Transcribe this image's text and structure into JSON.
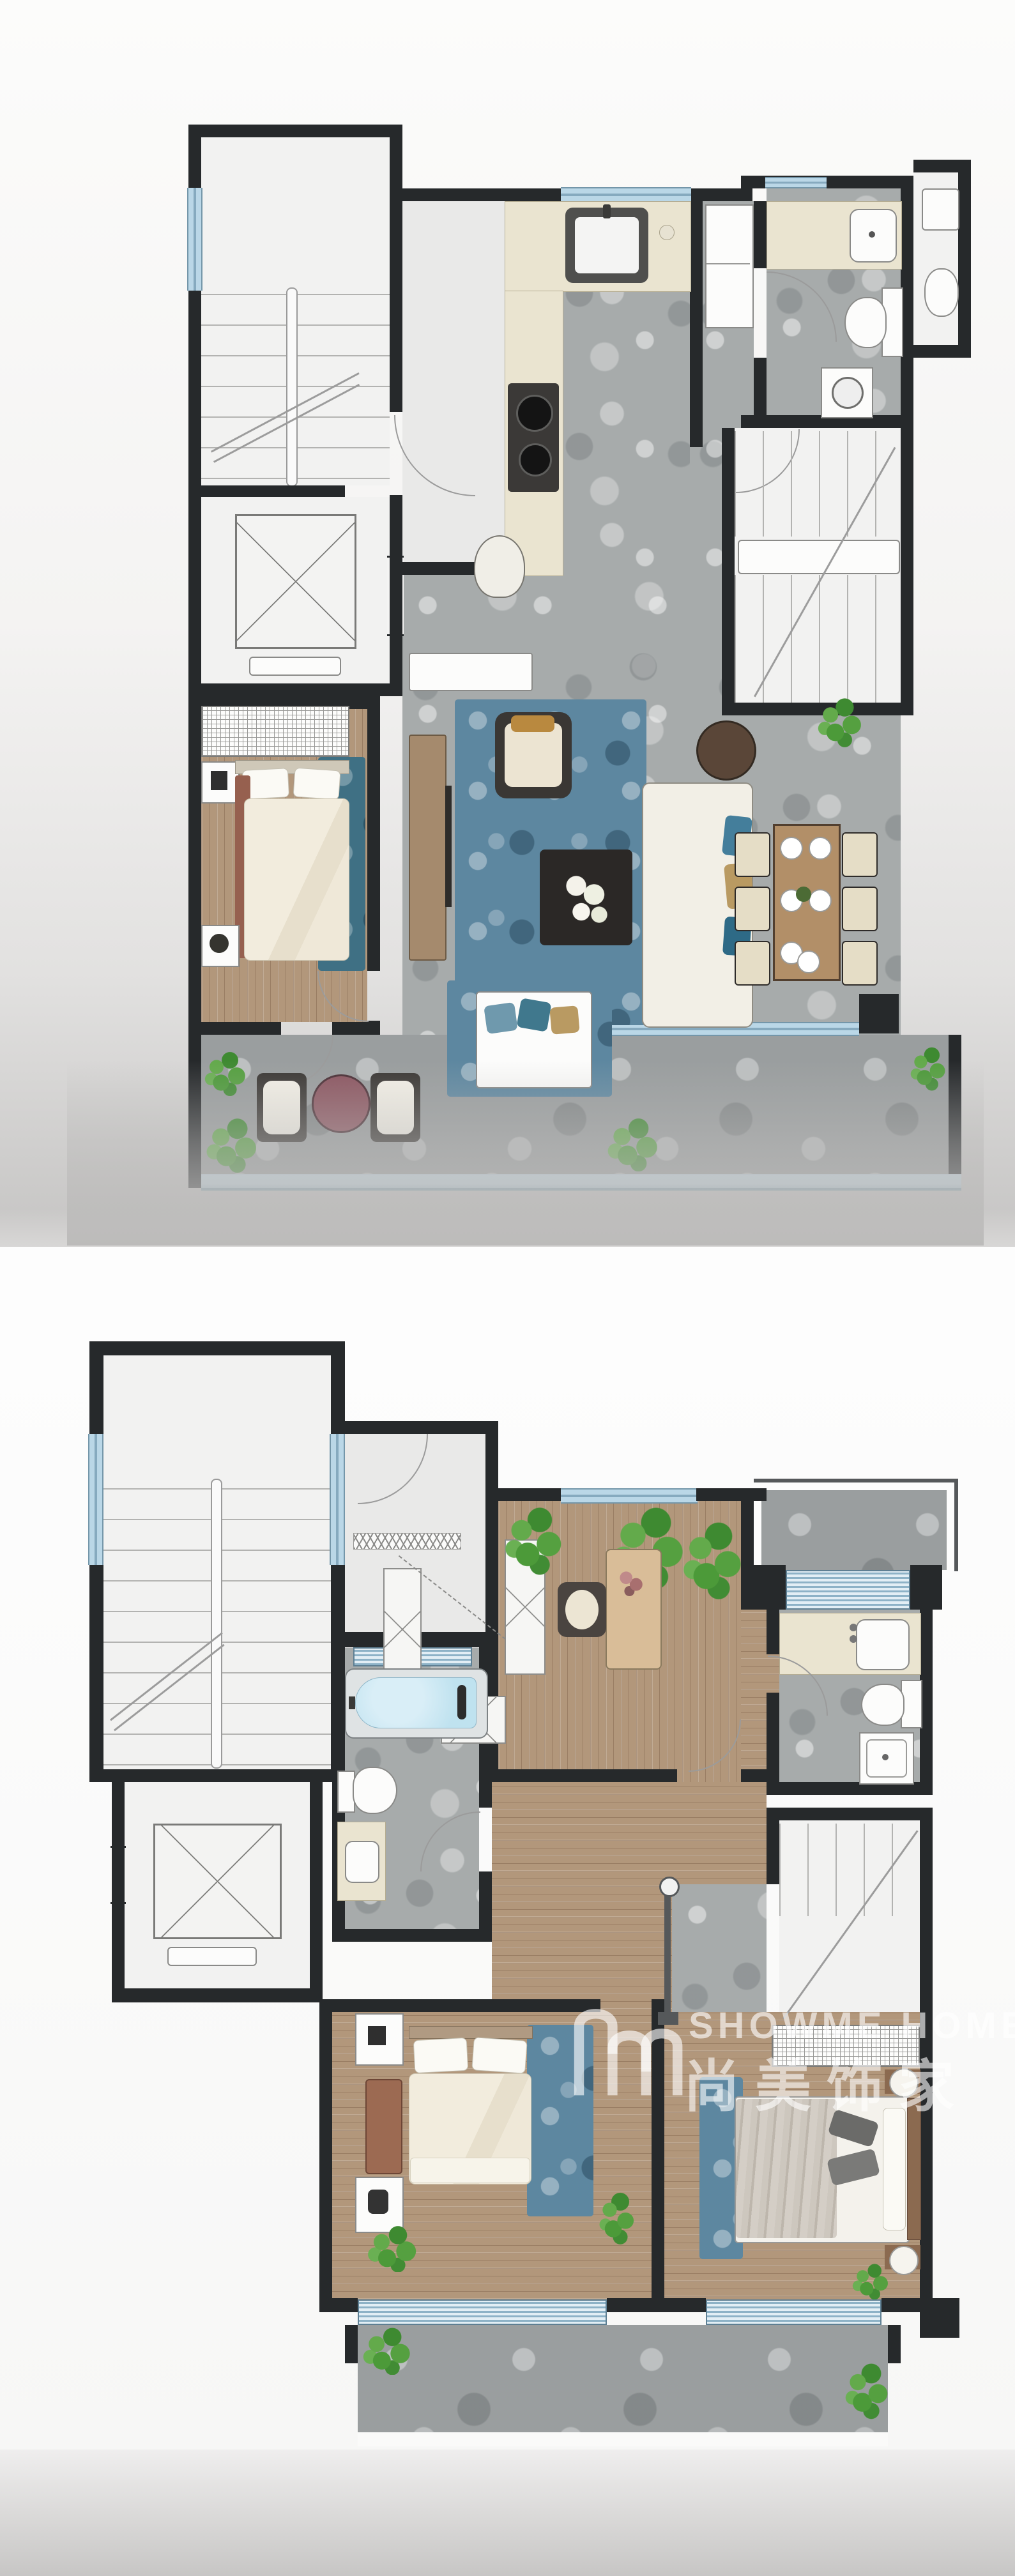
{
  "watermark": {
    "brand_latin": "SHOWME HOME",
    "brand_cn": "尚美饰家",
    "logo": "showme-home-bridge-m-logo",
    "text_color": "#ffffff",
    "opacity": 0.6
  },
  "palette": {
    "wall": "#26292b",
    "stone_floor": "#a7abab",
    "outdoor_stone": "#9a9e9f",
    "wood_floor": "#b2977b",
    "white_floor": "#f2f2f1",
    "window_glass": "#bad7e7",
    "louver_glass": "#8db2c7",
    "rug_blue": "#5d87a0",
    "rug_teal": "#3f7084",
    "counter_beige": "#eae4d0",
    "bathtub_water": "#bfe2ef",
    "plant_green": "#55a040",
    "outdoor_table_maroon": "#8c5661",
    "page_background": "#f6f6f5"
  },
  "plans": [
    {
      "id": "floor-plan-upper-image",
      "position": "top",
      "rooms": [
        "shared-stairwell",
        "elevator",
        "entry-hall",
        "kitchen",
        "bathroom",
        "powder-room",
        "internal-staircase",
        "living-room",
        "dining-area",
        "bedroom",
        "balcony",
        "terrace"
      ],
      "fixtures": [
        "stair-window",
        "kitchen-window",
        "bathroom-window",
        "kitchen-sink",
        "cooktop",
        "refrigerator",
        "vanity-basin",
        "toilet",
        "washing-machine",
        "glass-balustrade"
      ],
      "furniture": [
        "tv-console",
        "armchair",
        "sofa-with-pillows",
        "coffee-table-with-flowers",
        "round-side-table",
        "dining-table",
        "dining-chairs-x6",
        "plates-x6",
        "bed",
        "wardrobe",
        "nightstands-x2",
        "teal-rug",
        "blue-rug",
        "outdoor-lounge-chairs-x2",
        "outdoor-round-table",
        "daybed-with-blue-cushions",
        "console-table",
        "desk-chair",
        "plants"
      ]
    },
    {
      "id": "floor-plan-lower-image",
      "position": "bottom",
      "rooms": [
        "shared-stairwell",
        "elevator",
        "dressing-hall",
        "study-bedroom",
        "roof-terrace",
        "bathroom",
        "master-bathroom",
        "corridor",
        "internal-staircase",
        "master-bedroom",
        "second-bedroom",
        "rear-terrace"
      ],
      "fixtures": [
        "stairwell-windows-x2",
        "study-window",
        "louver-windows-x4",
        "bathtub",
        "toilets-x2",
        "vanities-x3",
        "shower-tray",
        "linen-closet-grid",
        "void-railing"
      ],
      "furniture": [
        "desk",
        "desk-chair",
        "hatched-wardrobes",
        "writing-desk",
        "master-bed",
        "bedside-bench",
        "nightstand-with-lamp",
        "second-bed-gray-bedding",
        "round-nightstands-x2",
        "blue-rugs-x2",
        "plants"
      ]
    }
  ]
}
